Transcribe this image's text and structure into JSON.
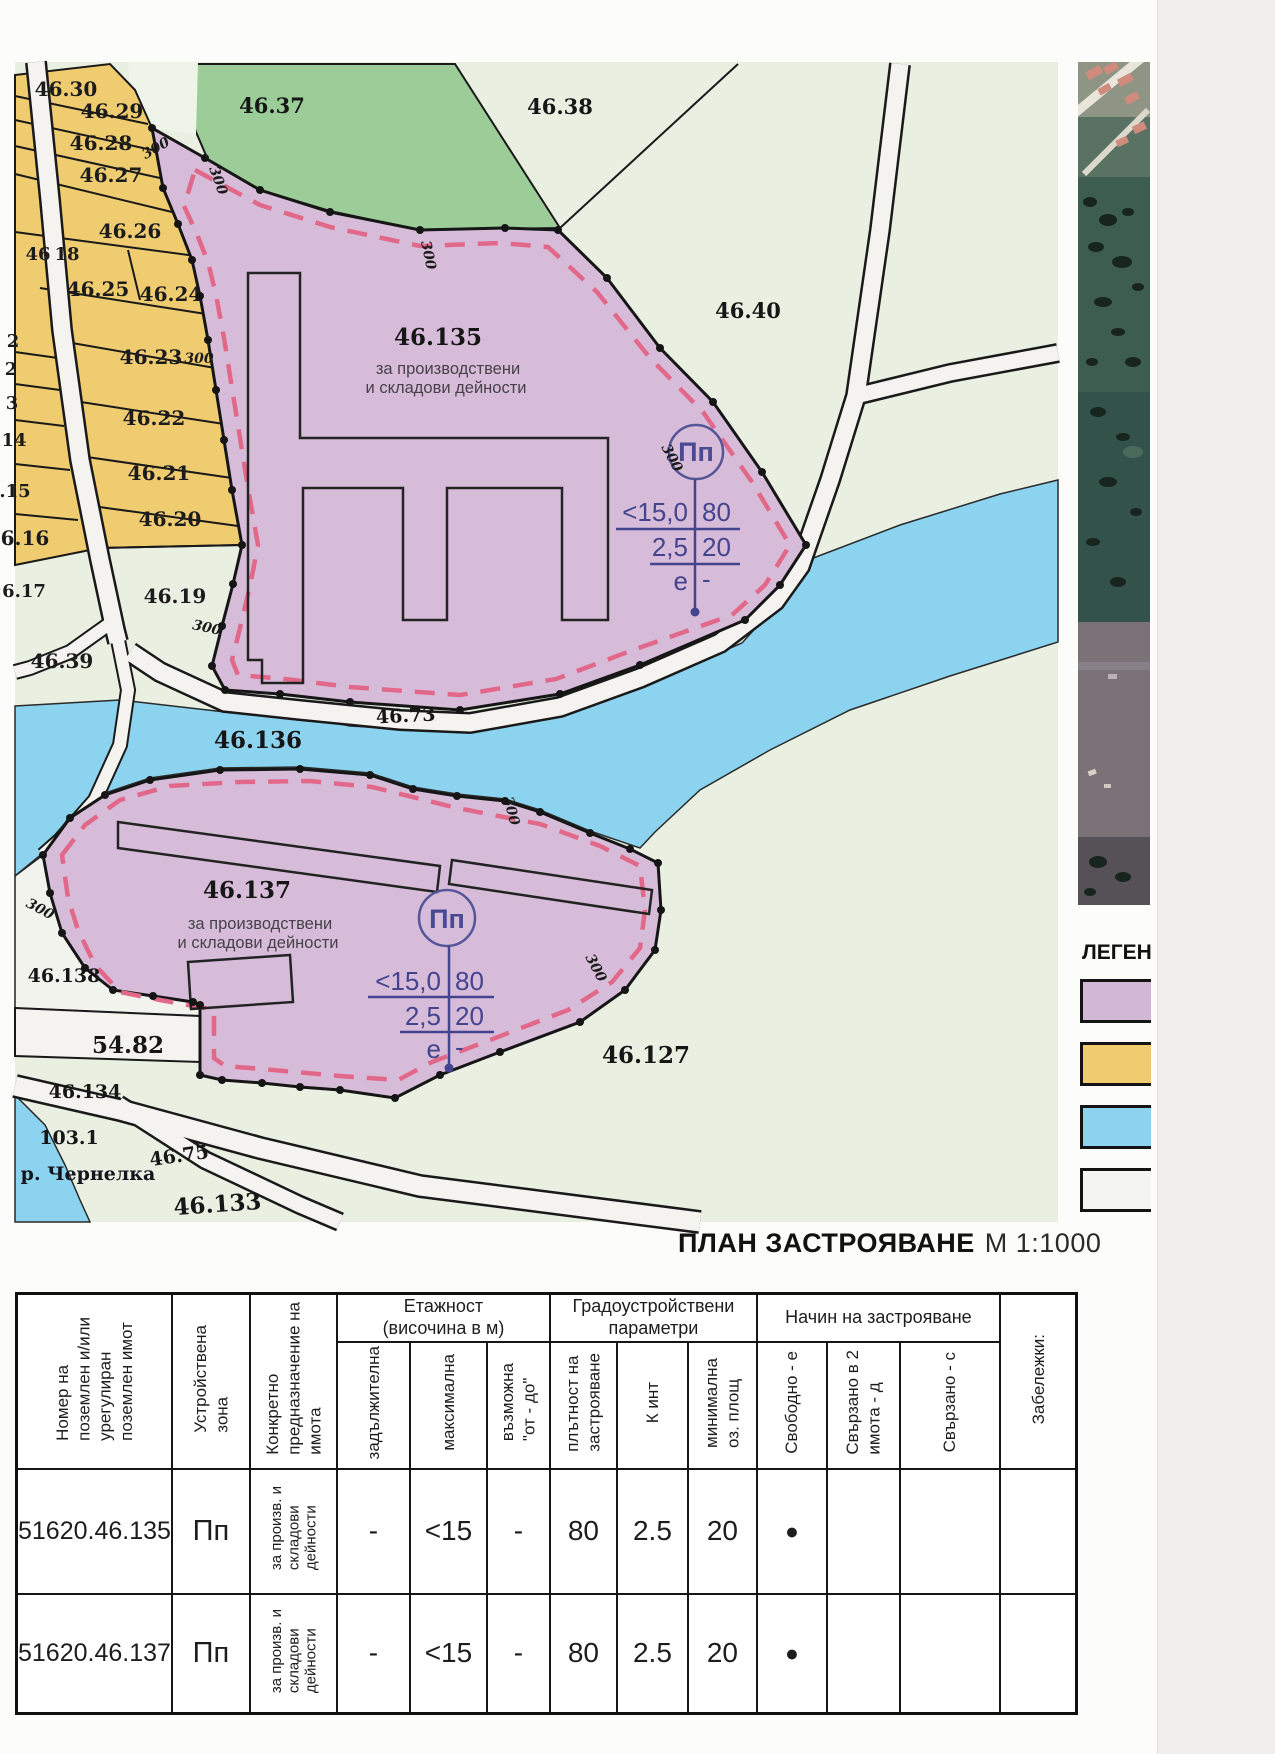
{
  "title": {
    "bold": "ПЛАН ЗАСТРОЯВАНЕ",
    "scale": "М 1:1000"
  },
  "legend": {
    "title": "ЛЕГЕНДА",
    "items": [
      {
        "name": "production-storage-zone",
        "color": "#d2b8d4"
      },
      {
        "name": "farmland-zone",
        "color": "#f0cc70"
      },
      {
        "name": "water-zone",
        "color": "#8bd3ee"
      },
      {
        "name": "road-zone",
        "color": "#f4f4f2"
      }
    ]
  },
  "map": {
    "zone_symbol": "Пп",
    "params": {
      "height": "<15,0",
      "density": "80",
      "kint": "2,5",
      "green": "20",
      "mode": "е",
      "dash": "-"
    },
    "labels": [
      {
        "t": "46.30",
        "x": 66,
        "y": 96,
        "c": "yl"
      },
      {
        "t": "46.29",
        "x": 112,
        "y": 118,
        "c": "yl"
      },
      {
        "t": "46.28",
        "x": 101,
        "y": 150,
        "c": "yl"
      },
      {
        "t": "46.27",
        "x": 111,
        "y": 182,
        "c": "yl"
      },
      {
        "t": "46.26",
        "x": 130,
        "y": 238,
        "c": "yl"
      },
      {
        "t": "46",
        "x": 38,
        "y": 260,
        "c": "yl2"
      },
      {
        "t": "18",
        "x": 67,
        "y": 260,
        "c": "yl2"
      },
      {
        "t": "46.25",
        "x": 98,
        "y": 296,
        "c": "yl"
      },
      {
        "t": "46.24",
        "x": 171,
        "y": 301,
        "c": "yl"
      },
      {
        "t": "2",
        "x": 13,
        "y": 347,
        "c": "yl2"
      },
      {
        "t": "2",
        "x": 11,
        "y": 375,
        "c": "yl2"
      },
      {
        "t": "46.23",
        "x": 151,
        "y": 364,
        "c": "yl"
      },
      {
        "t": "3",
        "x": 12,
        "y": 409,
        "c": "yl2"
      },
      {
        "t": "46.22",
        "x": 154,
        "y": 425,
        "c": "yl"
      },
      {
        "t": "14",
        "x": 14,
        "y": 446,
        "c": "yl2"
      },
      {
        "t": "46.21",
        "x": 159,
        "y": 480,
        "c": "yl"
      },
      {
        "t": ".15",
        "x": 15,
        "y": 497,
        "c": "yl2"
      },
      {
        "t": "46.20",
        "x": 170,
        "y": 526,
        "c": "yl"
      },
      {
        "t": "6.16",
        "x": 25,
        "y": 545,
        "c": "yl"
      },
      {
        "t": "6.17",
        "x": 24,
        "y": 597,
        "c": "yl2"
      },
      {
        "t": "46.19",
        "x": 175,
        "y": 603,
        "c": "yl"
      },
      {
        "t": "46.39",
        "x": 62,
        "y": 668,
        "c": "yl"
      },
      {
        "t": "46.37",
        "x": 272,
        "y": 113,
        "c": "grn"
      },
      {
        "t": "46.38",
        "x": 560,
        "y": 114,
        "c": "grn"
      },
      {
        "t": "46.40",
        "x": 748,
        "y": 318,
        "c": "grn"
      },
      {
        "t": "46.135",
        "x": 438,
        "y": 345,
        "c": "pl"
      },
      {
        "t": "46.136",
        "x": 258,
        "y": 748,
        "c": "pl"
      },
      {
        "t": "46.137",
        "x": 247,
        "y": 898,
        "c": "pl"
      },
      {
        "t": "46.73",
        "x": 406,
        "y": 722,
        "r": -3,
        "c": "pls"
      },
      {
        "t": "46.138",
        "x": 64,
        "y": 982,
        "c": "pls"
      },
      {
        "t": "54.82",
        "x": 128,
        "y": 1053,
        "c": "pl"
      },
      {
        "t": "46.134",
        "x": 85,
        "y": 1098,
        "c": "pls"
      },
      {
        "t": "103.1",
        "x": 69,
        "y": 1144,
        "c": "pls"
      },
      {
        "t": "р. Чернелка",
        "x": 88,
        "y": 1180,
        "c": "riv"
      },
      {
        "t": "46.75",
        "x": 180,
        "y": 1162,
        "r": -8,
        "c": "pls"
      },
      {
        "t": "46.133",
        "x": 218,
        "y": 1212,
        "r": -4,
        "c": "pl"
      },
      {
        "t": "46.127",
        "x": 646,
        "y": 1063,
        "c": "pl"
      },
      {
        "t": "за производствени",
        "x": 448,
        "y": 374,
        "c": "zn"
      },
      {
        "t": "и складови дейности",
        "x": 446,
        "y": 393,
        "c": "zn"
      },
      {
        "t": "за производствени",
        "x": 260,
        "y": 929,
        "c": "zn"
      },
      {
        "t": "и складови дейности",
        "x": 258,
        "y": 948,
        "c": "zn"
      },
      {
        "t": "300",
        "x": 199,
        "y": 363,
        "c": "m300"
      },
      {
        "t": "300",
        "x": 158,
        "y": 152,
        "r": -30,
        "c": "m300"
      },
      {
        "t": "300",
        "x": 214,
        "y": 182,
        "r": 70,
        "c": "m300"
      },
      {
        "t": "300",
        "x": 424,
        "y": 256,
        "r": 78,
        "c": "m300"
      },
      {
        "t": "300",
        "x": 668,
        "y": 460,
        "r": 62,
        "c": "m300"
      },
      {
        "t": "300",
        "x": 206,
        "y": 632,
        "r": 12,
        "c": "m300"
      },
      {
        "t": "300",
        "x": 38,
        "y": 913,
        "r": 28,
        "c": "m300"
      },
      {
        "t": "300",
        "x": 507,
        "y": 812,
        "r": 75,
        "c": "m300"
      },
      {
        "t": "300",
        "x": 592,
        "y": 970,
        "r": 62,
        "c": "m300"
      }
    ]
  },
  "table": {
    "headers": {
      "parcel": "Номер на\nпоземлен и/или\nурегулиран\nпоземлен имот",
      "zone": "Устройствена\nзона",
      "purpose": "Конкретно\nпредназначение на\nимота",
      "grp_floors": "Етажност\n(височина в м)",
      "mandatory": "задължителна",
      "max": "максимална",
      "possible": "възможна\n\"от - до\"",
      "grp_urban": "Градоустройствени\nпараметри",
      "density": "плътност на\nзастрояване",
      "kint": "К инт",
      "green": "минимална\nоз. площ",
      "grp_mode": "Начин на застрояване",
      "free": "Свободно - е",
      "attached2": "Свързано в 2\nимота - д",
      "attached": "Свързано - с",
      "notes": "Забележки:"
    },
    "rows": [
      {
        "id": "51620.46.135",
        "zone": "Пп",
        "purpose": "за произв. и\nскладови\nдейности",
        "mandatory": "-",
        "max": "<15",
        "possible": "-",
        "density": "80",
        "kint": "2.5",
        "green": "20",
        "free": "●",
        "attached2": "",
        "attached": "",
        "notes": ""
      },
      {
        "id": "51620.46.137",
        "zone": "Пп",
        "purpose": "за произв. и\nскладови\nдейности",
        "mandatory": "-",
        "max": "<15",
        "possible": "-",
        "density": "80",
        "kint": "2.5",
        "green": "20",
        "free": "●",
        "attached2": "",
        "attached": "",
        "notes": ""
      }
    ]
  }
}
